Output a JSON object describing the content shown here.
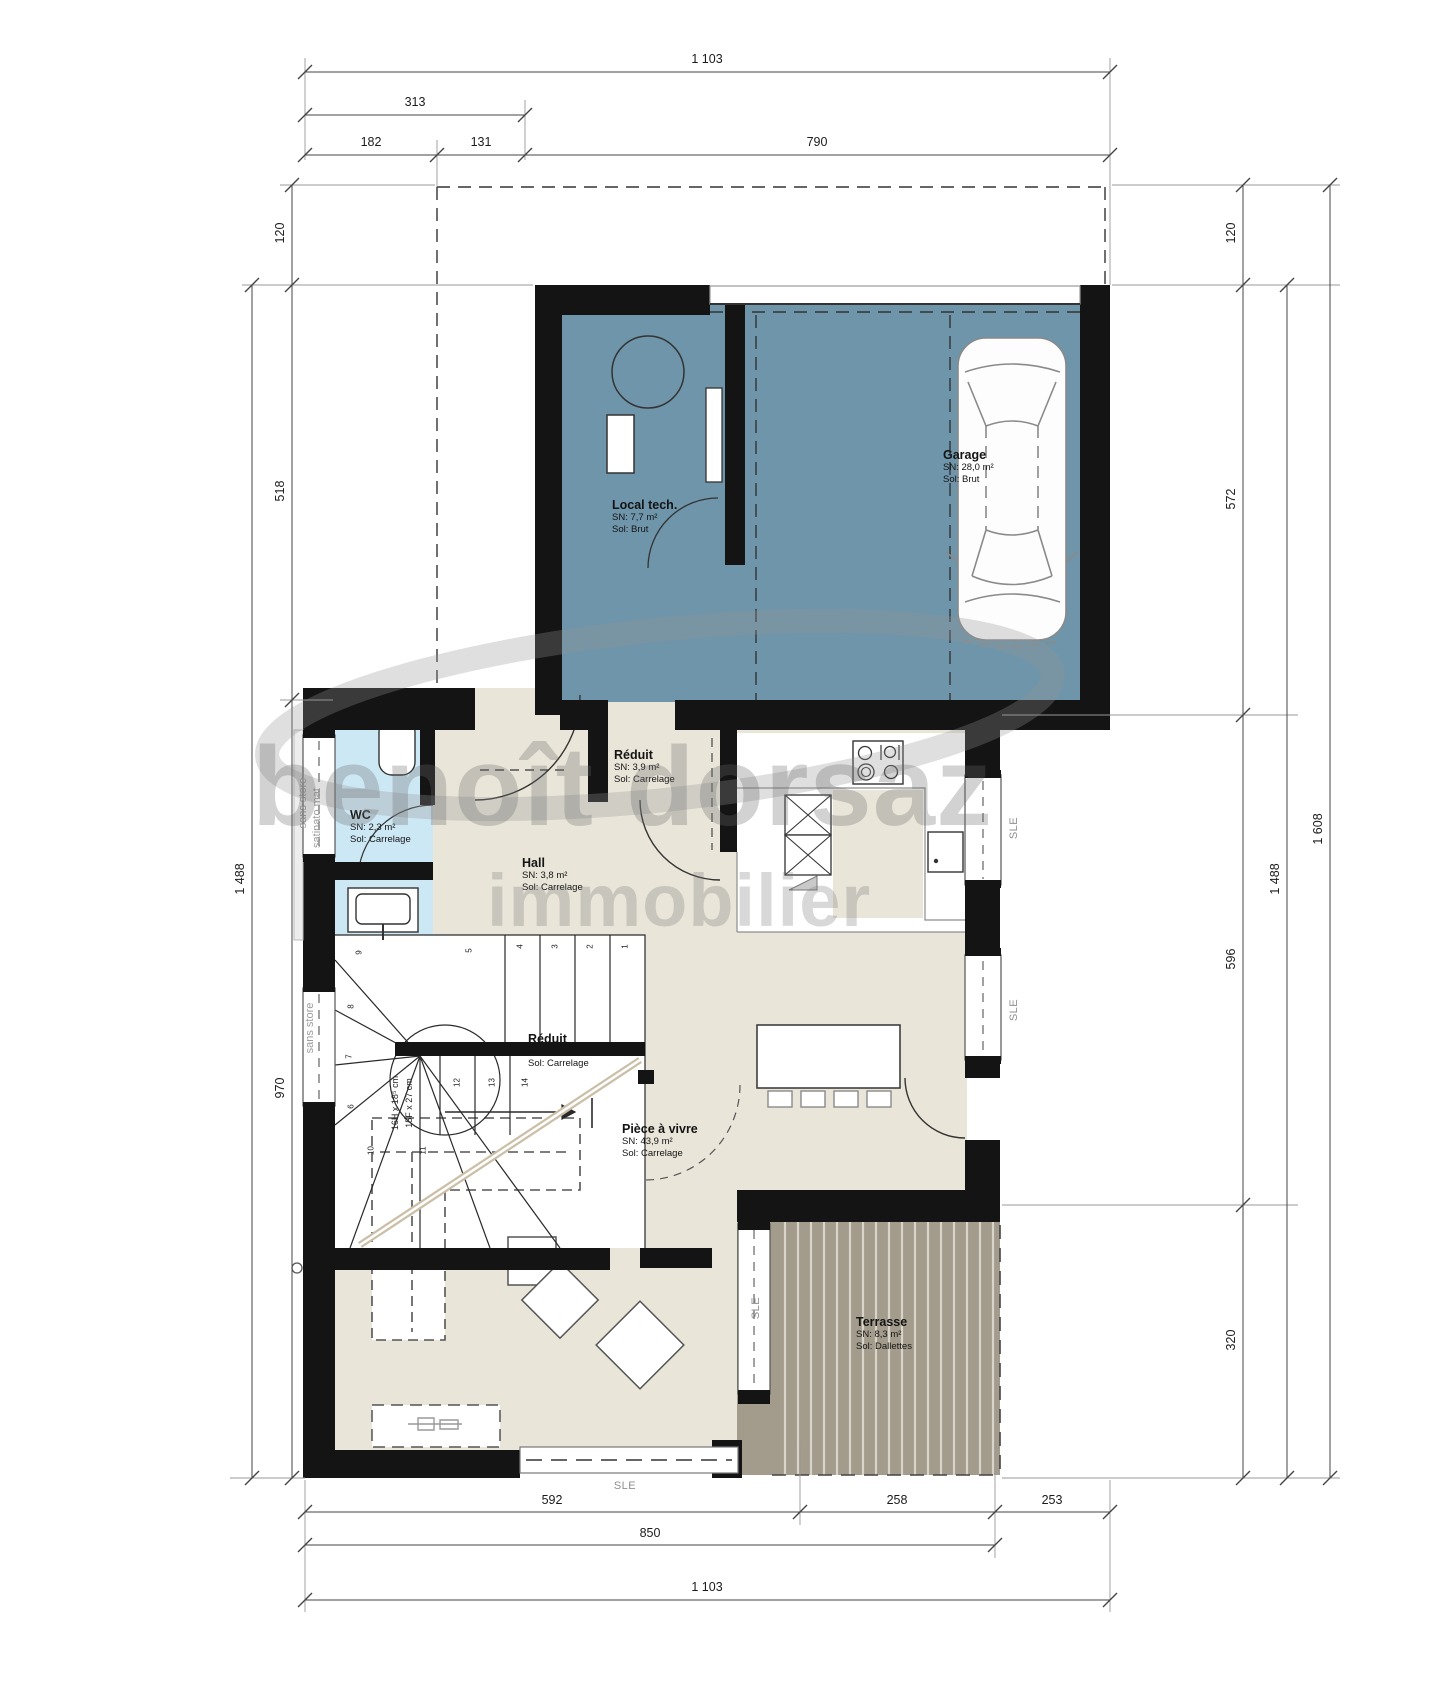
{
  "watermark": {
    "primary": "benoît dorsaz",
    "secondary": "immobilier"
  },
  "rooms": {
    "local_tech": {
      "name": "Local tech.",
      "area": "SN: 7,7 m²",
      "floor": "Sol: Brut"
    },
    "garage": {
      "name": "Garage",
      "area": "SN: 28,0 m²",
      "floor": "Sol: Brut"
    },
    "reduit_haut": {
      "name": "Réduit",
      "area": "SN: 3,9 m²",
      "floor": "Sol: Carrelage"
    },
    "wc": {
      "name": "WC",
      "area": "SN: 2,3 m²",
      "floor": "Sol: Carrelage"
    },
    "hall": {
      "name": "Hall",
      "area": "SN: 3,8 m²",
      "floor": "Sol: Carrelage"
    },
    "reduit_bas": {
      "name": "Réduit",
      "area": "SN: 2,1 m²",
      "floor": "Sol: Carrelage"
    },
    "piece_a_vivre": {
      "name": "Pièce à vivre",
      "area": "SN: 43,9 m²",
      "floor": "Sol: Carrelage"
    },
    "terrasse": {
      "name": "Terrasse",
      "area": "SN: 8,3 m²",
      "floor": "Sol: Dallettes"
    }
  },
  "dimensions": {
    "top": {
      "total": "1 103",
      "group": "313",
      "seg1": "182",
      "seg2": "131",
      "seg3": "790"
    },
    "left": {
      "seg1": "120",
      "seg2": "518",
      "seg3": "970",
      "total": "1 488"
    },
    "right": {
      "seg1": "120",
      "seg2": "572",
      "seg3": "596",
      "seg4": "320",
      "subtotal": "1 488",
      "total": "1 608"
    },
    "bottom": {
      "seg1": "592",
      "seg2": "258",
      "seg3": "253",
      "subtotal": "850",
      "total": "1 103"
    }
  },
  "annotations": {
    "window_label": "SLE",
    "blind_note_1": "sans store",
    "blind_note_2": "satinato mat",
    "blind_note_3": "sans store",
    "stair_note_line1": "16H x 18⁵ cm",
    "stair_note_line2": "15F x 27 cm",
    "stair_steps": [
      "1",
      "2",
      "3",
      "4",
      "5",
      "6",
      "7",
      "8",
      "9",
      "10",
      "11",
      "12",
      "13",
      "14"
    ]
  },
  "colors": {
    "garage_fill": "#6e95a9",
    "wc_fill": "#cde8f5",
    "floor_fill": "#e9e5d9",
    "terrace_fill": "#a39b8b",
    "wall": "#141414"
  }
}
